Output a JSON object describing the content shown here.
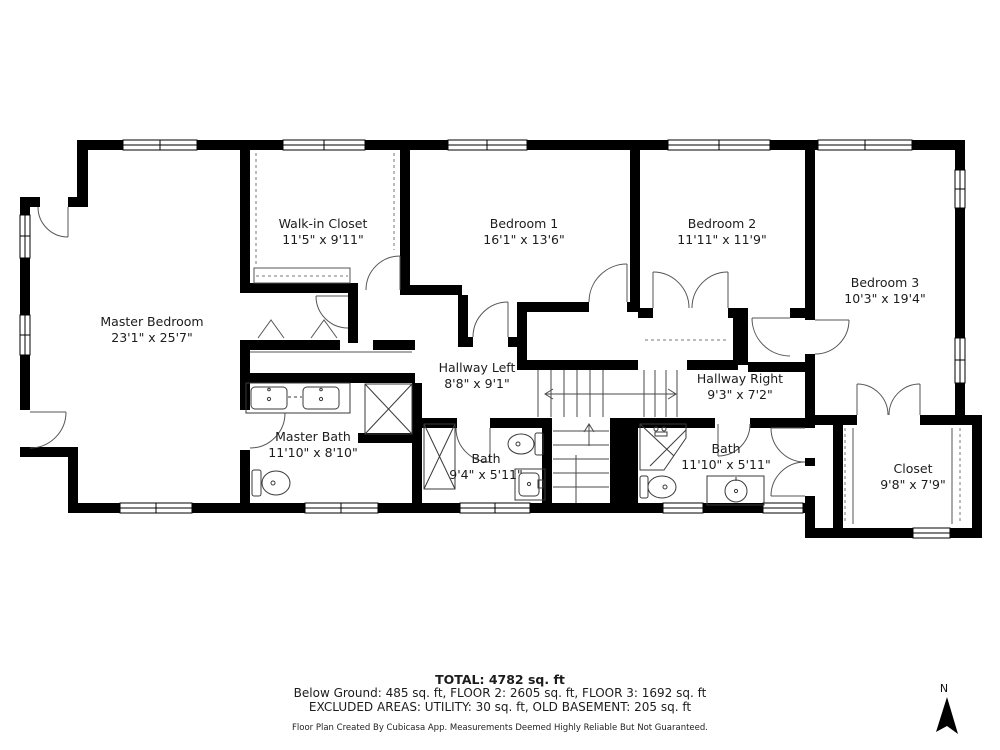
{
  "plan": {
    "rooms": [
      {
        "id": "master-bedroom",
        "name": "Master Bedroom",
        "dims": "23'1\" x 25'7\""
      },
      {
        "id": "walk-in-closet",
        "name": "Walk-in Closet",
        "dims": "11'5\" x 9'11\""
      },
      {
        "id": "bedroom-1",
        "name": "Bedroom 1",
        "dims": "16'1\" x 13'6\""
      },
      {
        "id": "bedroom-2",
        "name": "Bedroom 2",
        "dims": "11'11\" x 11'9\""
      },
      {
        "id": "bedroom-3",
        "name": "Bedroom 3",
        "dims": "10'3\" x 19'4\""
      },
      {
        "id": "hallway-left",
        "name": "Hallway Left",
        "dims": "8'8\" x 9'1\""
      },
      {
        "id": "hallway-right",
        "name": "Hallway Right",
        "dims": "9'3\" x 7'2\""
      },
      {
        "id": "master-bath",
        "name": "Master Bath",
        "dims": "11'10\" x 8'10\""
      },
      {
        "id": "bath-left",
        "name": "Bath",
        "dims": "9'4\" x 5'11\""
      },
      {
        "id": "bath-right",
        "name": "Bath",
        "dims": "11'10\" x 5'11\""
      },
      {
        "id": "closet",
        "name": "Closet",
        "dims": "9'8\" x 7'9\""
      }
    ]
  },
  "footer": {
    "total": "TOTAL: 4782 sq. ft",
    "floors": "Below Ground: 485 sq. ft, FLOOR 2: 2605 sq. ft, FLOOR 3: 1692 sq. ft",
    "excluded": "EXCLUDED AREAS: UTILITY: 30 sq. ft, OLD BASEMENT: 205 sq. ft",
    "disclaimer": "Floor Plan Created By Cubicasa App. Measurements Deemed Highly Reliable But Not Guaranteed."
  },
  "compass": {
    "label": "N"
  },
  "colors": {
    "wall": "#000000",
    "detail": "#4a4a4a",
    "dashed": "#8a8a8a",
    "background": "#ffffff"
  }
}
